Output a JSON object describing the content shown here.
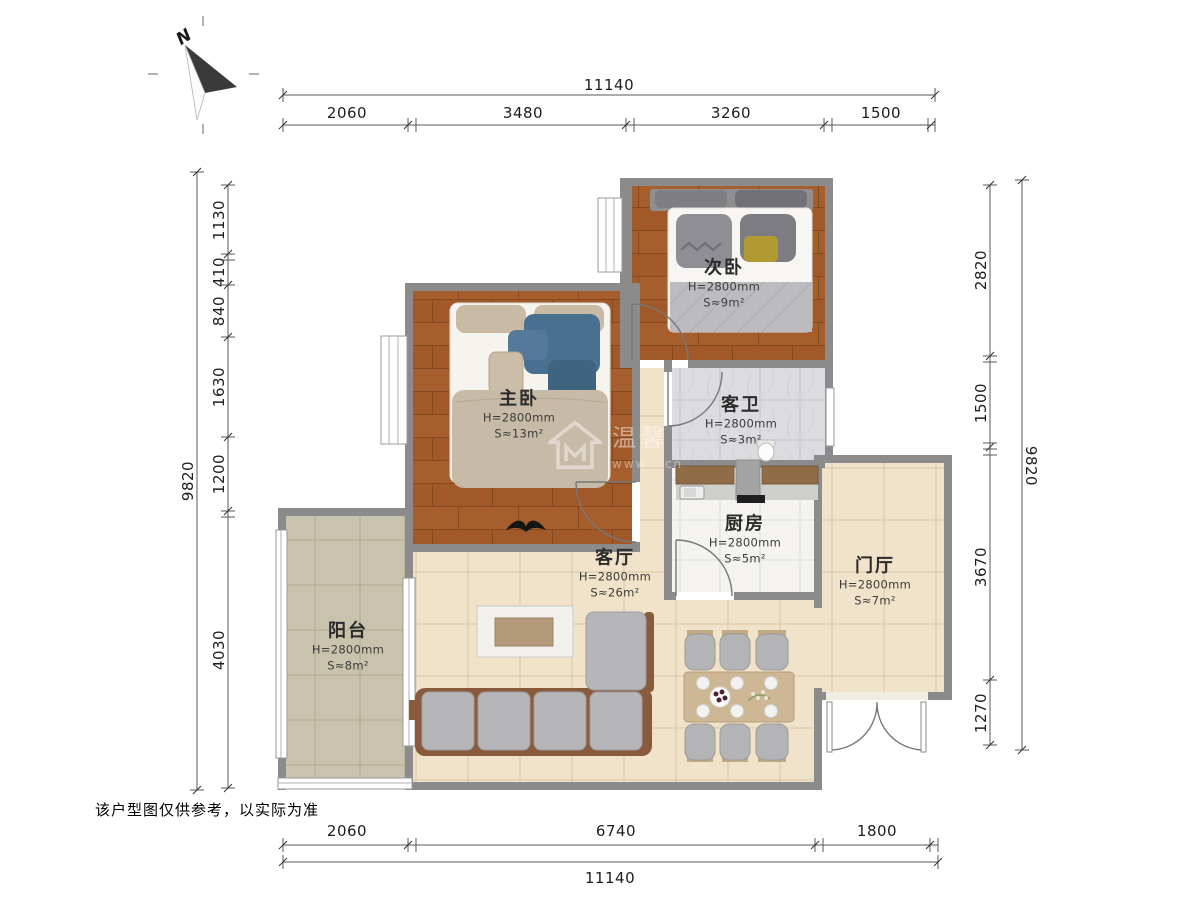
{
  "compass": {
    "label": "N"
  },
  "disclaimer": "该户型图仅供参考，以实际为准",
  "watermark": {
    "icon": "house-logo-icon",
    "text": "温馨",
    "url_text": "www···cn"
  },
  "dimensions": {
    "top": {
      "total": "11140",
      "segments": [
        "2060",
        "3480",
        "3260",
        "1500"
      ]
    },
    "bottom": {
      "total": "11140",
      "segments": [
        "2060",
        "6740",
        "1800"
      ]
    },
    "left": {
      "total": "9820",
      "segments": [
        "1130",
        "410",
        "840",
        "1630",
        "1200",
        "4030"
      ]
    },
    "right": {
      "total": "9820",
      "segments": [
        "2820",
        "1500",
        "3670",
        "1270"
      ]
    }
  },
  "rooms": {
    "secondary_bedroom": {
      "name": "次卧",
      "height": "H=2800mm",
      "area": "S≈9m²"
    },
    "master_bedroom": {
      "name": "主卧",
      "height": "H=2800mm",
      "area": "S≈13m²"
    },
    "guest_bathroom": {
      "name": "客卫",
      "height": "H=2800mm",
      "area": "S≈3m²"
    },
    "kitchen": {
      "name": "厨房",
      "height": "H=2800mm",
      "area": "S≈5m²"
    },
    "living_room": {
      "name": "客厅",
      "height": "H=2800mm",
      "area": "S≈26m²"
    },
    "foyer": {
      "name": "门厅",
      "height": "H=2800mm",
      "area": "S≈7m²"
    },
    "balcony": {
      "name": "阳台",
      "height": "H=2800mm",
      "area": "S≈8m²"
    }
  },
  "colors": {
    "wall": "#8b8b8b",
    "wood_floor": "#a2592a",
    "tile_beige": "#f1e2ca",
    "tile_balcony": "#c9c3ad",
    "tile_kitchen": "#f4f3f0",
    "tile_marble": "#dcdce0",
    "sofa_frame_brown": "#8a5a3c",
    "cushion_gray": "#b6b6b8",
    "blanket_blue": "#49718f",
    "dim_line": "#5a5a5a"
  }
}
